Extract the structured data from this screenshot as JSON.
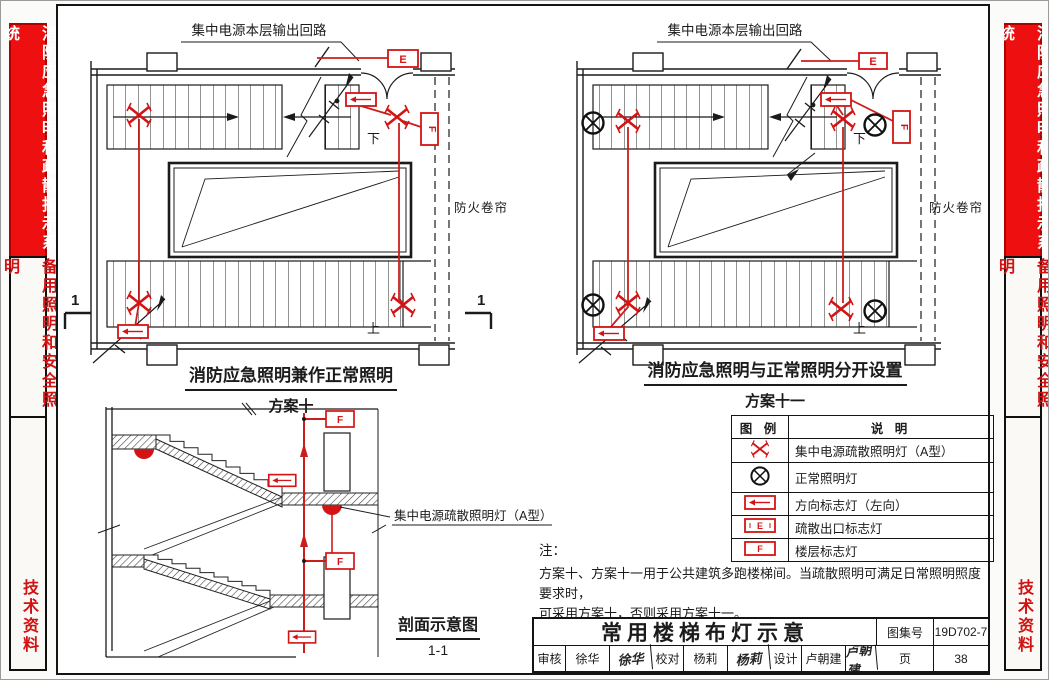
{
  "sidebar": {
    "top": "消防应急照明和疏散指示系统",
    "middle": "备用照明和安全照明",
    "bottom": "技术资料"
  },
  "plans": {
    "circuit_label": "集中电源本层输出回路",
    "down": "下",
    "up": "上",
    "fire_shutter": "防火卷帘",
    "section_mark": "1",
    "e_letter": "E",
    "f_letter": "F",
    "plan1": {
      "title": "消防应急照明兼作正常照明",
      "scheme": "方案十"
    },
    "plan2": {
      "title": "消防应急照明与正常照明分开设置",
      "scheme": "方案十一"
    }
  },
  "section": {
    "lamp_label": "集中电源疏散照明灯（A型）",
    "caption": "剖面示意图",
    "caption_sub": "1-1",
    "f_letter": "F"
  },
  "legend": {
    "header": {
      "symbol": "图 例",
      "desc": "说 明"
    },
    "rows": [
      {
        "symbol": "emergency-lamp",
        "desc": "集中电源疏散照明灯（A型）"
      },
      {
        "symbol": "normal-lamp",
        "desc": "正常照明灯"
      },
      {
        "symbol": "direction-sign",
        "desc": "方向标志灯（左向）"
      },
      {
        "symbol": "exit-sign",
        "desc": "疏散出口标志灯"
      },
      {
        "symbol": "floor-sign",
        "desc": "楼层标志灯"
      }
    ]
  },
  "notes": {
    "label": "注：",
    "line1": "方案十、方案十一用于公共建筑多跑楼梯间。当疏散照明可满足日常照明照度要求时，",
    "line2": "可采用方案十，否则采用方案十一。"
  },
  "titleblock": {
    "title": "常用楼梯布灯示意",
    "atlas_label": "图集号",
    "atlas_no": "19D702-7",
    "page_label": "页",
    "page_no": "38",
    "review_label": "审核",
    "review_name": "徐华",
    "review_sig": "徐华",
    "proof_label": "校对",
    "proof_name": "杨莉",
    "proof_sig": "杨莉",
    "design_label": "设计",
    "design_name": "卢朝建",
    "design_sig": "卢朝建"
  },
  "colors": {
    "accent_red": "#ee1010",
    "drawing_red": "#cc1d1d",
    "line_black": "#1b1b1b"
  }
}
